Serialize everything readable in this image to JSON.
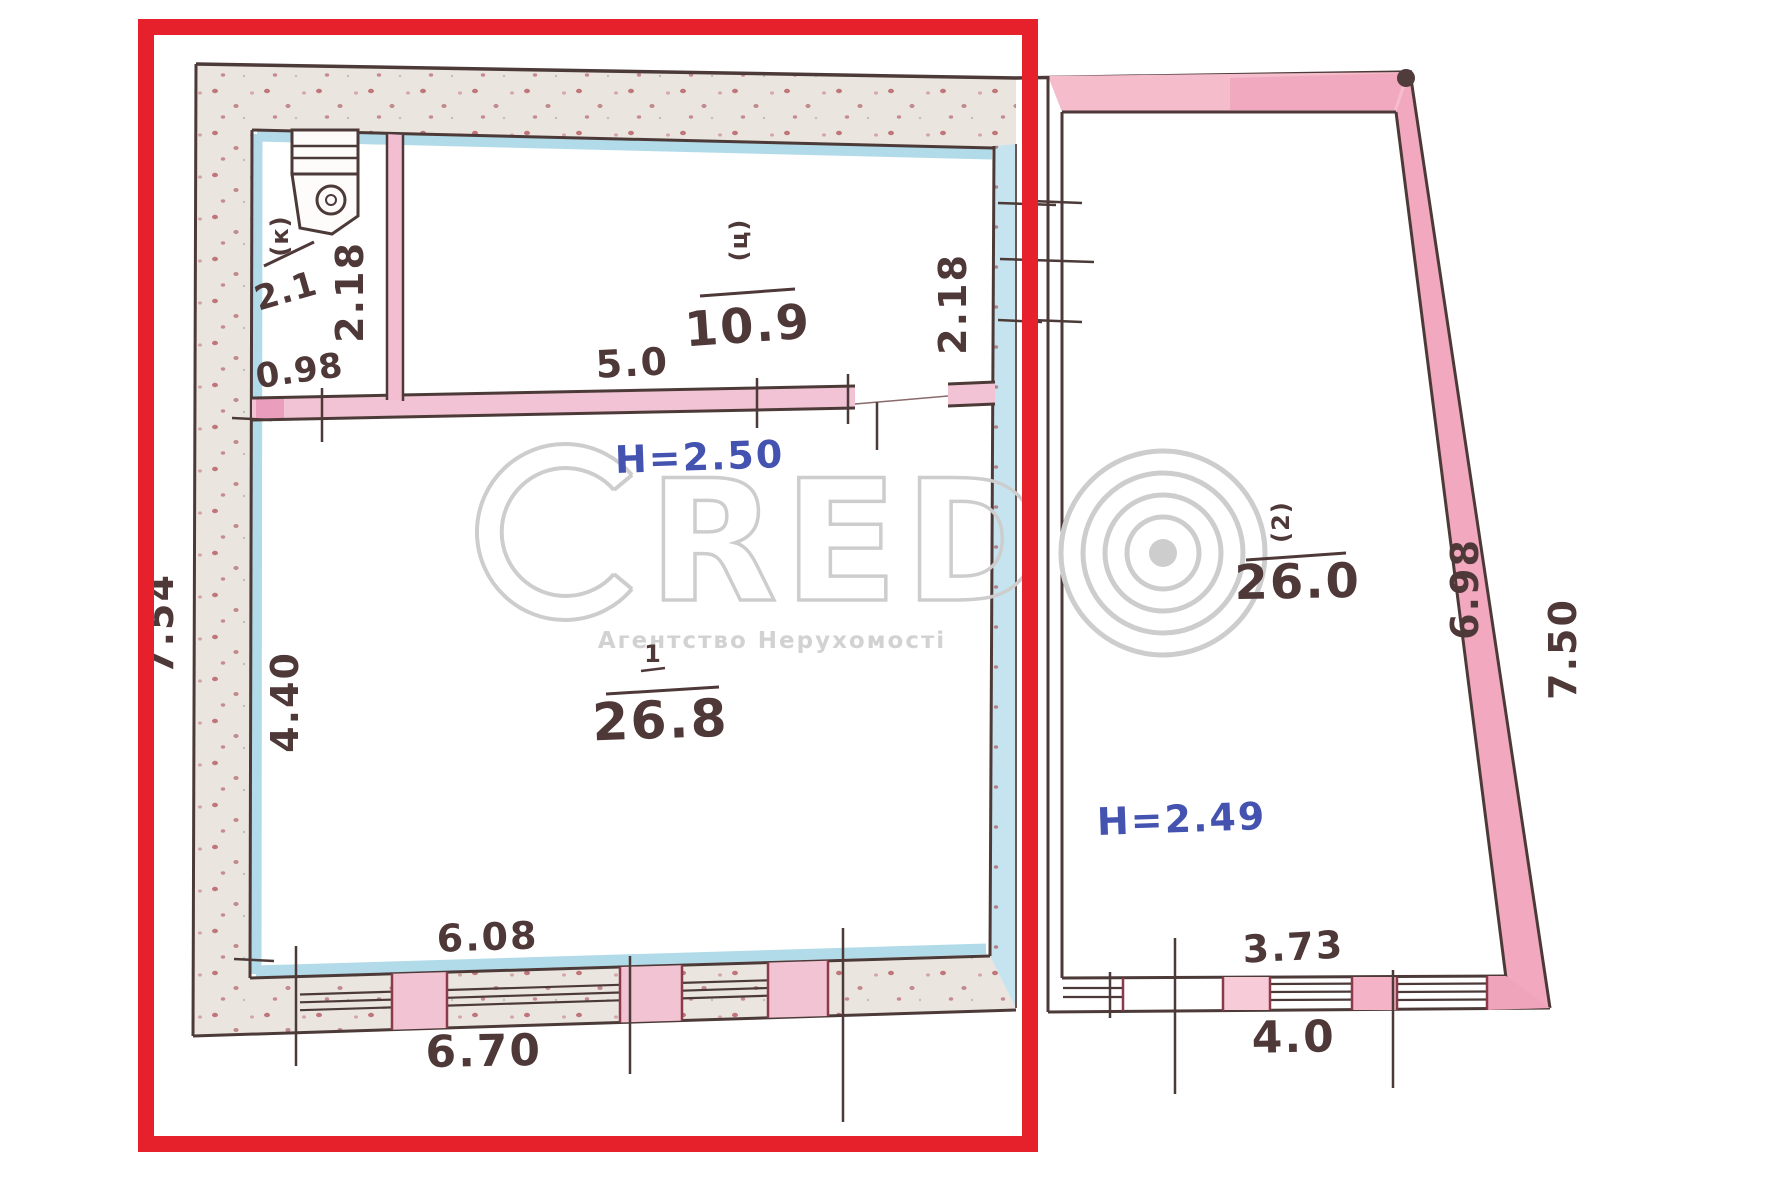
{
  "watermark": {
    "letter_c": "C",
    "letters_red": "RED",
    "copyright_mark": "©",
    "agency_line": "Агентство Нерухомості"
  },
  "highlight": {
    "color": "#e7212b"
  },
  "left_building": {
    "height_label": "H=2.50",
    "rooms": {
      "closet": {
        "marker": "(к)",
        "area": "2.1"
      },
      "top_room": {
        "marker": "(ц)",
        "area": "10.9"
      },
      "main_room": {
        "marker": "1",
        "area": "26.8"
      }
    },
    "dims": {
      "outer_height": "7.54",
      "main_room_height": "4.40",
      "closet_width": "0.98",
      "closet_height": "2.18",
      "top_room_width": "5.0",
      "top_room_height": "2.18",
      "bottom_inner_width": "6.08",
      "bottom_outer_width": "6.70"
    }
  },
  "right_building": {
    "height_label": "H=2.49",
    "room": {
      "marker": "(2)",
      "area": "26.0"
    },
    "dims": {
      "inner_height": "6.98",
      "outer_height": "7.50",
      "bottom_window_width": "3.73",
      "bottom_outer_width": "4.0"
    }
  }
}
